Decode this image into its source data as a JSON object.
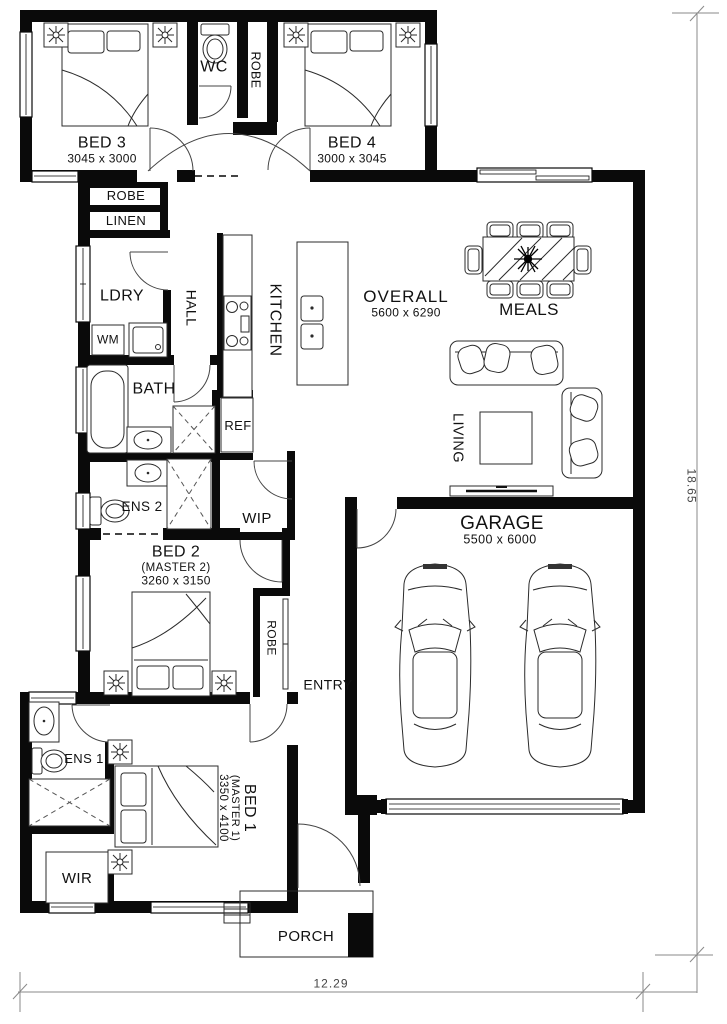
{
  "page": {
    "type": "residential floor plan",
    "colors": {
      "wall": "#0a0a0a",
      "furniture_line": "#2b2b2b",
      "dimension_line": "#8a8a8a",
      "text": "#111111",
      "background": "#ffffff"
    }
  },
  "rooms": {
    "bed3": {
      "name": "BED 3",
      "dims": "3045 x 3000"
    },
    "wc": {
      "name": "WC"
    },
    "robe_top": {
      "name": "ROBE"
    },
    "bed4": {
      "name": "BED 4",
      "dims": "3000 x 3045"
    },
    "robe_bed3": {
      "name": "ROBE"
    },
    "linen": {
      "name": "LINEN"
    },
    "ldry": {
      "name": "LDRY"
    },
    "wm": {
      "name": "WM"
    },
    "hall": {
      "name": "HALL"
    },
    "kitchen": {
      "name": "KITCHEN"
    },
    "overall": {
      "name": "OVERALL",
      "dims": "5600 x 6290"
    },
    "meals": {
      "name": "MEALS"
    },
    "bath": {
      "name": "BATH"
    },
    "ref": {
      "name": "REF"
    },
    "ens2": {
      "name": "ENS 2"
    },
    "wip": {
      "name": "WIP"
    },
    "living": {
      "name": "LIVING"
    },
    "garage": {
      "name": "GARAGE",
      "dims": "5500 x 6000"
    },
    "bed2": {
      "name": "BED 2",
      "sub": "(MASTER 2)",
      "dims": "3260 x 3150"
    },
    "robe_bed2": {
      "name": "ROBE"
    },
    "entry": {
      "name": "ENTRY"
    },
    "ens1": {
      "name": "ENS 1"
    },
    "bed1": {
      "name": "BED 1",
      "sub": "(MASTER 1)",
      "dims": "3350 x 4100"
    },
    "wir": {
      "name": "WIR"
    },
    "porch": {
      "name": "PORCH"
    }
  },
  "dimensions": {
    "overall_width_m": "12.29",
    "overall_depth_m": "18.65"
  }
}
